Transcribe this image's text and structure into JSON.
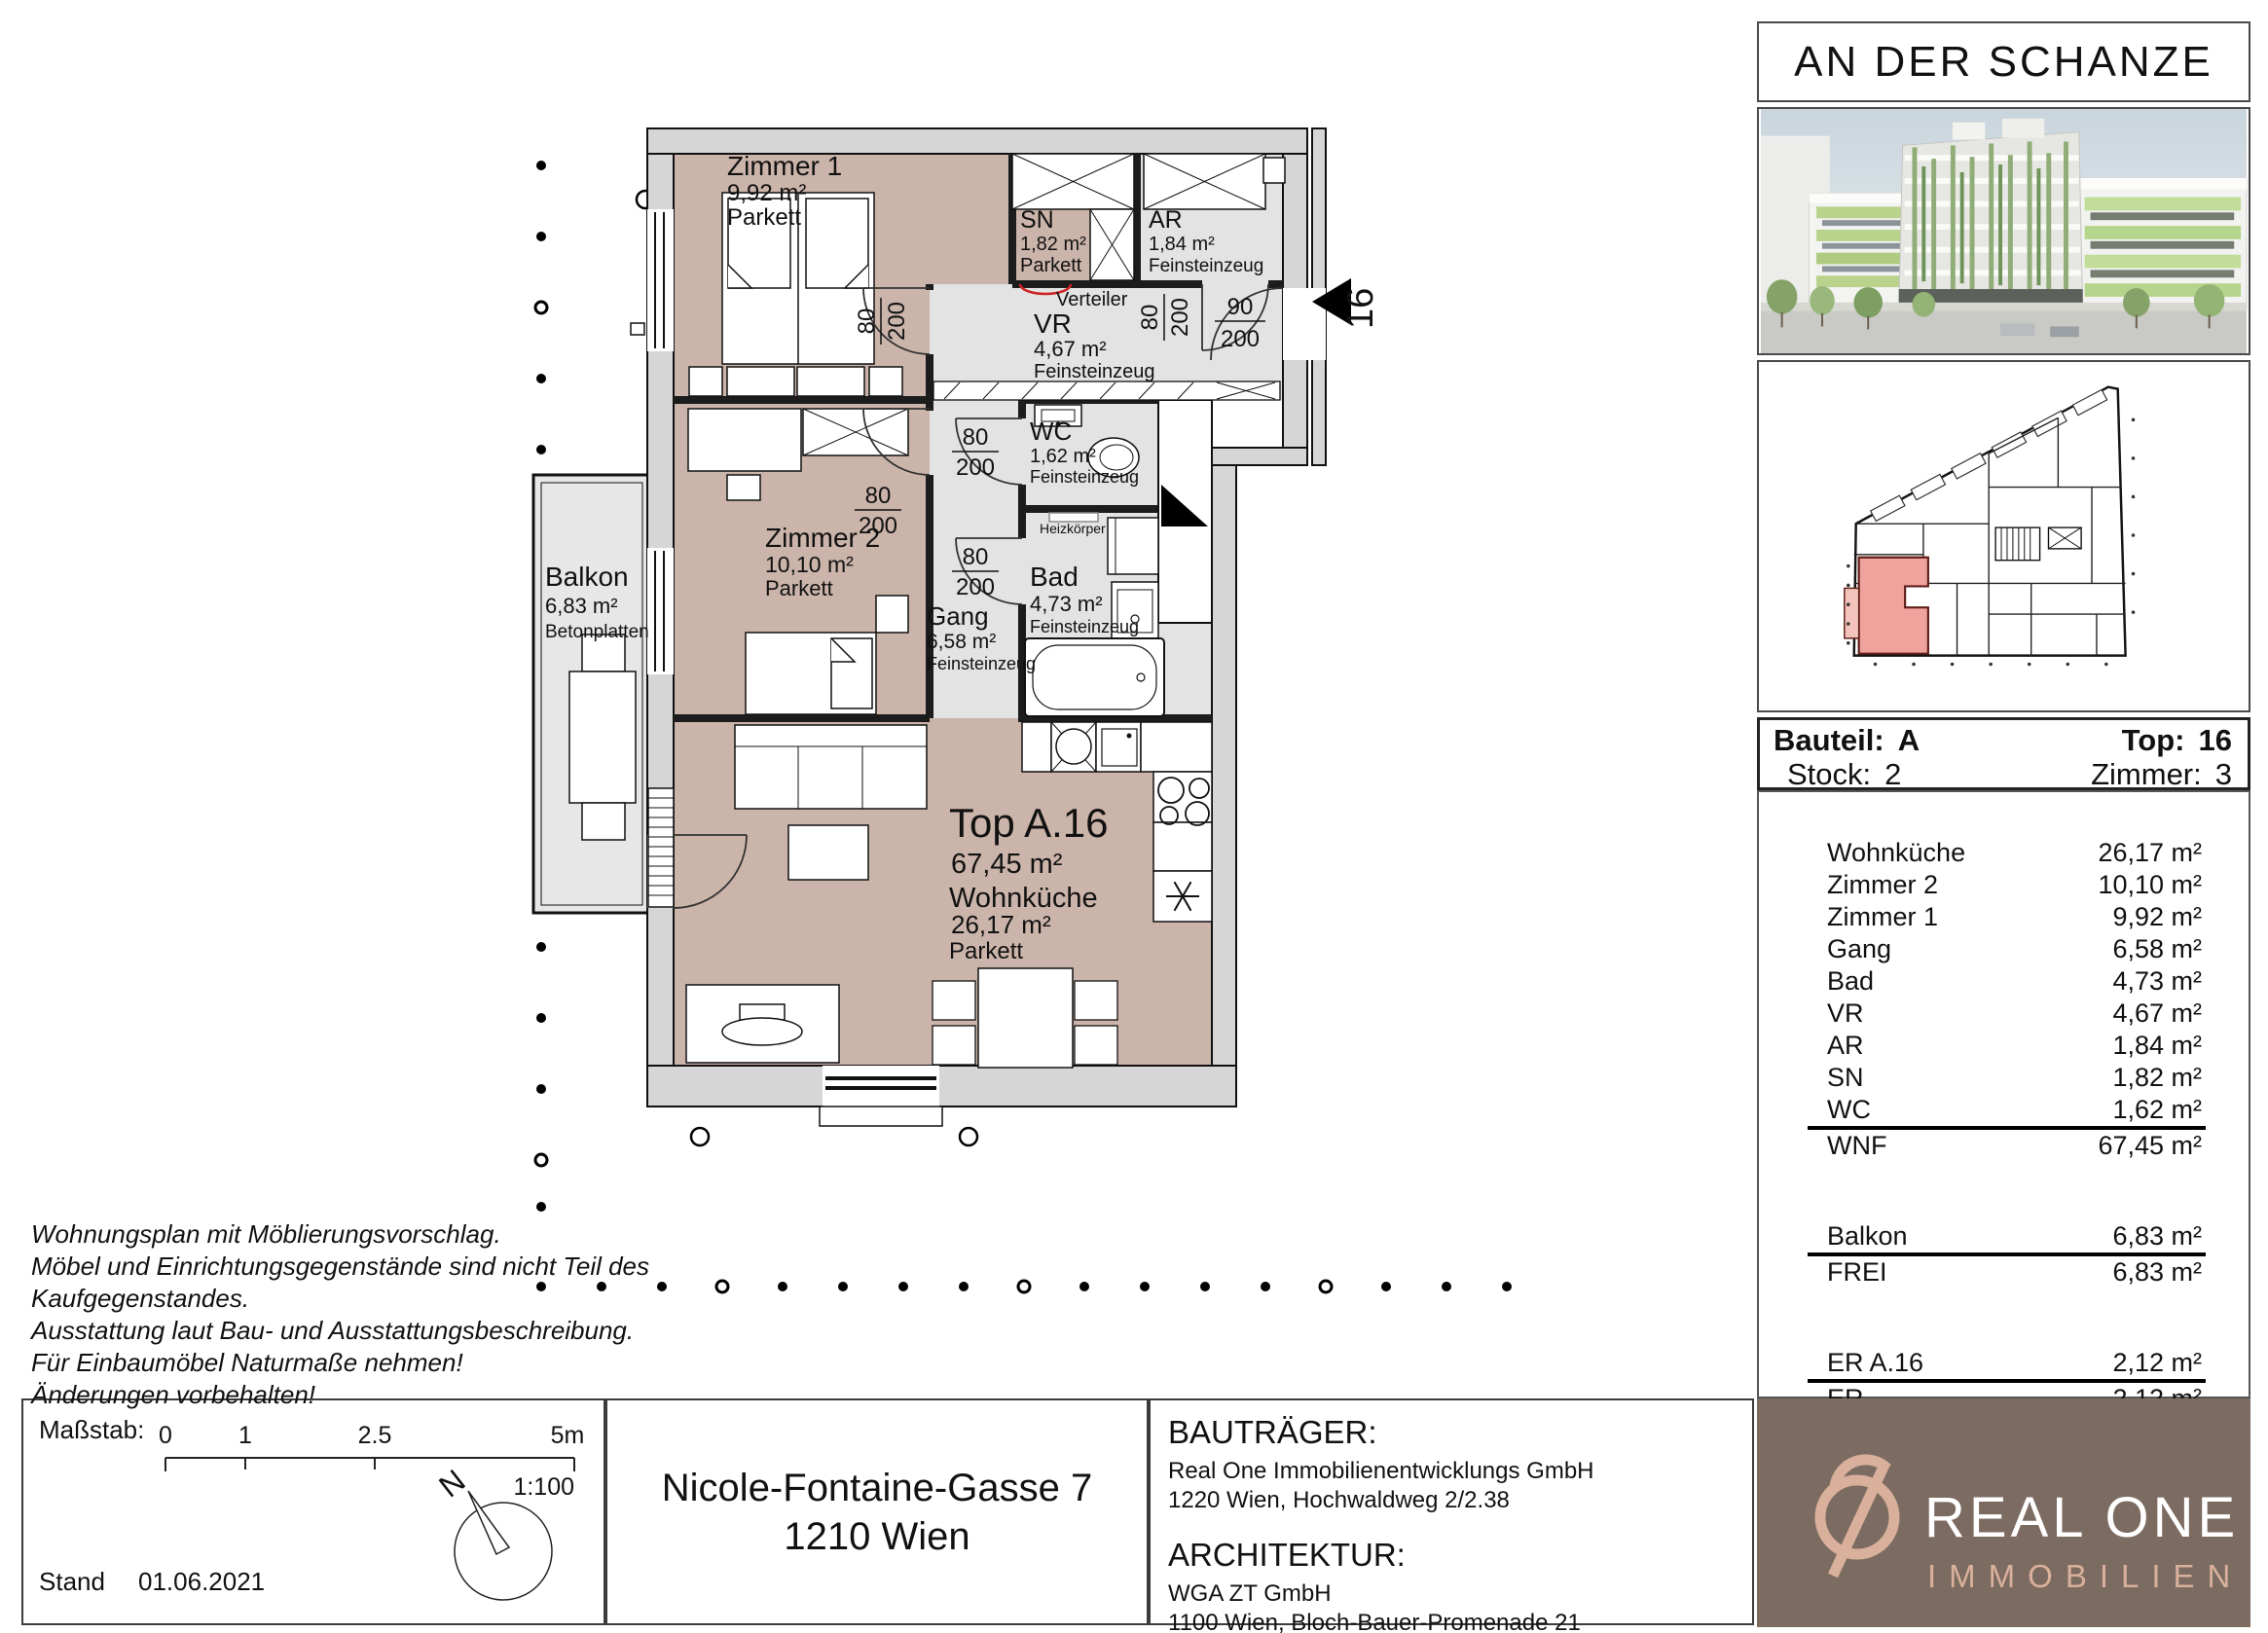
{
  "project": {
    "title": "AN DER SCHANZE"
  },
  "plan": {
    "unit": {
      "name": "Top A.16",
      "area": "67,45 m²",
      "number": "16"
    },
    "rooms": {
      "zimmer1": {
        "name": "Zimmer 1",
        "area": "9,92 m²",
        "floor": "Parkett"
      },
      "sn": {
        "name": "SN",
        "area": "1,82 m²",
        "floor": "Parkett"
      },
      "ar": {
        "name": "AR",
        "area": "1,84 m²",
        "floor": "Feinsteinzeug"
      },
      "vr": {
        "name": "VR",
        "area": "4,67 m²",
        "floor": "Feinsteinzeug"
      },
      "wc": {
        "name": "WC",
        "area": "1,62 m²",
        "floor": "Feinsteinzeug"
      },
      "bad": {
        "name": "Bad",
        "area": "4,73 m²",
        "floor": "Feinsteinzeug"
      },
      "gang": {
        "name": "Gang",
        "area": "6,58 m²",
        "floor": "Feinsteinzeug"
      },
      "zimmer2": {
        "name": "Zimmer 2",
        "area": "10,10 m²",
        "floor": "Parkett"
      },
      "wohnkueche": {
        "name": "Wohnküche",
        "area": "26,17 m²",
        "floor": "Parkett"
      },
      "balkon": {
        "name": "Balkon",
        "area": "6,83 m²",
        "floor": "Betonplatten"
      }
    },
    "annotations": {
      "verteiler": "Verteiler",
      "heizkoerper": "Heizkörper"
    },
    "dims": {
      "door_width": "80",
      "door_height": "200",
      "entry_width": "90",
      "entry_height": "200"
    }
  },
  "sidebar": {
    "title": "AN DER SCHANZE",
    "info": {
      "bauteil_label": "Bauteil:",
      "bauteil_value": "A",
      "top_label": "Top:",
      "top_value": "16",
      "stock_label": "Stock:",
      "stock_value": "2",
      "zimmer_label": "Zimmer:",
      "zimmer_value": "3"
    },
    "area_table": {
      "rows": [
        {
          "label": "Wohnküche",
          "value": "26,17 m²"
        },
        {
          "label": "Zimmer 2",
          "value": "10,10 m²"
        },
        {
          "label": "Zimmer 1",
          "value": "9,92 m²"
        },
        {
          "label": "Gang",
          "value": "6,58 m²"
        },
        {
          "label": "Bad",
          "value": "4,73 m²"
        },
        {
          "label": "VR",
          "value": "4,67 m²"
        },
        {
          "label": "AR",
          "value": "1,84 m²"
        },
        {
          "label": "SN",
          "value": "1,82 m²"
        },
        {
          "label": "WC",
          "value": "1,62 m²"
        },
        {
          "label": "WNF",
          "value": "67,45 m²"
        },
        {
          "label": "Balkon",
          "value": "6,83 m²"
        },
        {
          "label": "FREI",
          "value": "6,83 m²"
        },
        {
          "label": "ER A.16",
          "value": "2,12 m²"
        },
        {
          "label": "ER",
          "value": "2,12 m²"
        }
      ]
    },
    "logo": {
      "name": "REAL ONE",
      "subtitle": "IMMOBILIEN"
    }
  },
  "footer": {
    "disclaimer_lines": [
      "Wohnungsplan mit Möblierungsvorschlag.",
      "Möbel und Einrichtungsgegenstände sind nicht Teil des",
      "Kaufgegenstandes.",
      "Ausstattung laut Bau- und Ausstattungsbeschreibung.",
      "Für Einbaumöbel Naturmaße nehmen!",
      "Änderungen vorbehalten!"
    ],
    "scale": {
      "label": "Maßstab:",
      "tick0": "0",
      "tick1": "1",
      "tick2": "2.5",
      "tick3": "5m",
      "ratio": "1:100",
      "north": "N"
    },
    "stand_label": "Stand",
    "stand_date": "01.06.2021",
    "address_line1": "Nicole-Fontaine-Gasse 7",
    "address_line2": "1210 Wien",
    "developer": {
      "heading": "BAUTRÄGER:",
      "name": "Real One Immobilienentwicklungs GmbH",
      "address": "1220 Wien, Hochwaldweg 2/2.38"
    },
    "architect": {
      "heading": "ARCHITEKTUR:",
      "name": "WGA ZT GmbH",
      "address": "1100 Wien, Bloch-Bauer-Promenade 21"
    }
  },
  "colors": {
    "floor_living": "#cbb4aa",
    "floor_service": "#e3e3e3",
    "wall": "#d6d6d6",
    "unit_highlight": "#efa39c",
    "accent_red": "#e02b1d",
    "logo_brown": "#7c6b61",
    "logo_pink": "#d9b09b"
  }
}
